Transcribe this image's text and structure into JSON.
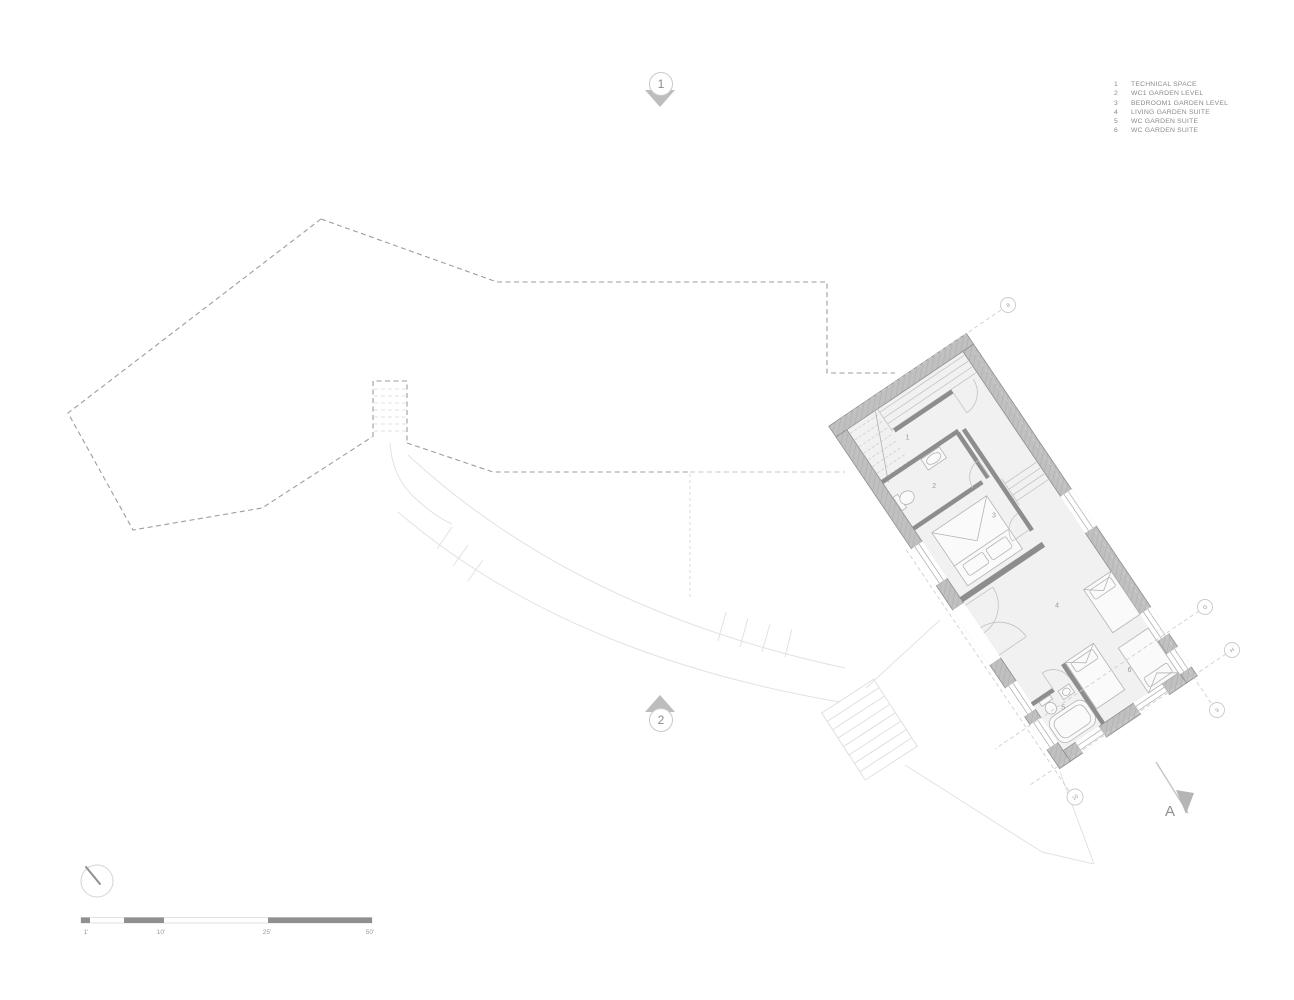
{
  "title": "Garden level floor plan",
  "legend": {
    "items": [
      {
        "num": "1",
        "label": "TECHNICAL SPACE"
      },
      {
        "num": "2",
        "label": "WC1 GARDEN LEVEL"
      },
      {
        "num": "3",
        "label": "BEDROOM1 GARDEN LEVEL"
      },
      {
        "num": "4",
        "label": "LIVING GARDEN SUITE"
      },
      {
        "num": "5",
        "label": "WC GARDEN SUITE"
      },
      {
        "num": "6",
        "label": "WC GARDEN SUITE"
      }
    ]
  },
  "section_markers": {
    "top": "1",
    "bottom": "2"
  },
  "plan": {
    "room_labels": [
      "1",
      "2",
      "3",
      "4",
      "5",
      "6"
    ]
  },
  "grid_markers": {
    "g8": "8",
    "gG": "G",
    "gH": "H",
    "g9": "9",
    "g10": "10"
  },
  "elevation_marker": {
    "label": "A"
  },
  "scale_bar": {
    "ticks": [
      "1'",
      "10'",
      "25'",
      "50'"
    ]
  },
  "colors": {
    "wall_fill": "#c0c0c0",
    "wall_edge": "#8f8f8f",
    "partition": "#8d8d8d",
    "floor": "#f1f1f1",
    "site_dash": "#9d9d9d",
    "light_path": "#e2e2e2",
    "text": "#8b8b8b",
    "marker_triangle": "#bdbdbd",
    "scale_dark": "#8f8f8f"
  }
}
